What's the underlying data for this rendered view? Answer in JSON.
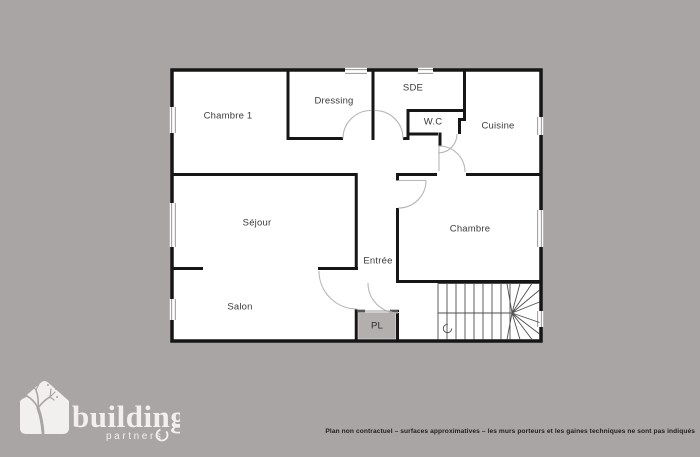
{
  "background_color": "#a9a5a4",
  "plan": {
    "floor_color": "#ffffff",
    "wall_color": "#161616",
    "closet_fill": "#b2afae",
    "rooms": [
      {
        "id": "chambre1",
        "label": "Chambre 1"
      },
      {
        "id": "dressing",
        "label": "Dressing"
      },
      {
        "id": "sde",
        "label": "SDE"
      },
      {
        "id": "wc",
        "label": "W.C"
      },
      {
        "id": "cuisine",
        "label": "Cuisine"
      },
      {
        "id": "sejour",
        "label": "Séjour"
      },
      {
        "id": "chambre",
        "label": "Chambre"
      },
      {
        "id": "entree",
        "label": "Entrée"
      },
      {
        "id": "salon",
        "label": "Salon"
      },
      {
        "id": "pl",
        "label": "PL"
      }
    ]
  },
  "logo": {
    "brand": "building",
    "sub": "partners"
  },
  "footer": {
    "disclaimer": "Plan non contractuel – surfaces approximatives – les murs porteurs et les gaines techniques ne sont pas indiqués"
  }
}
